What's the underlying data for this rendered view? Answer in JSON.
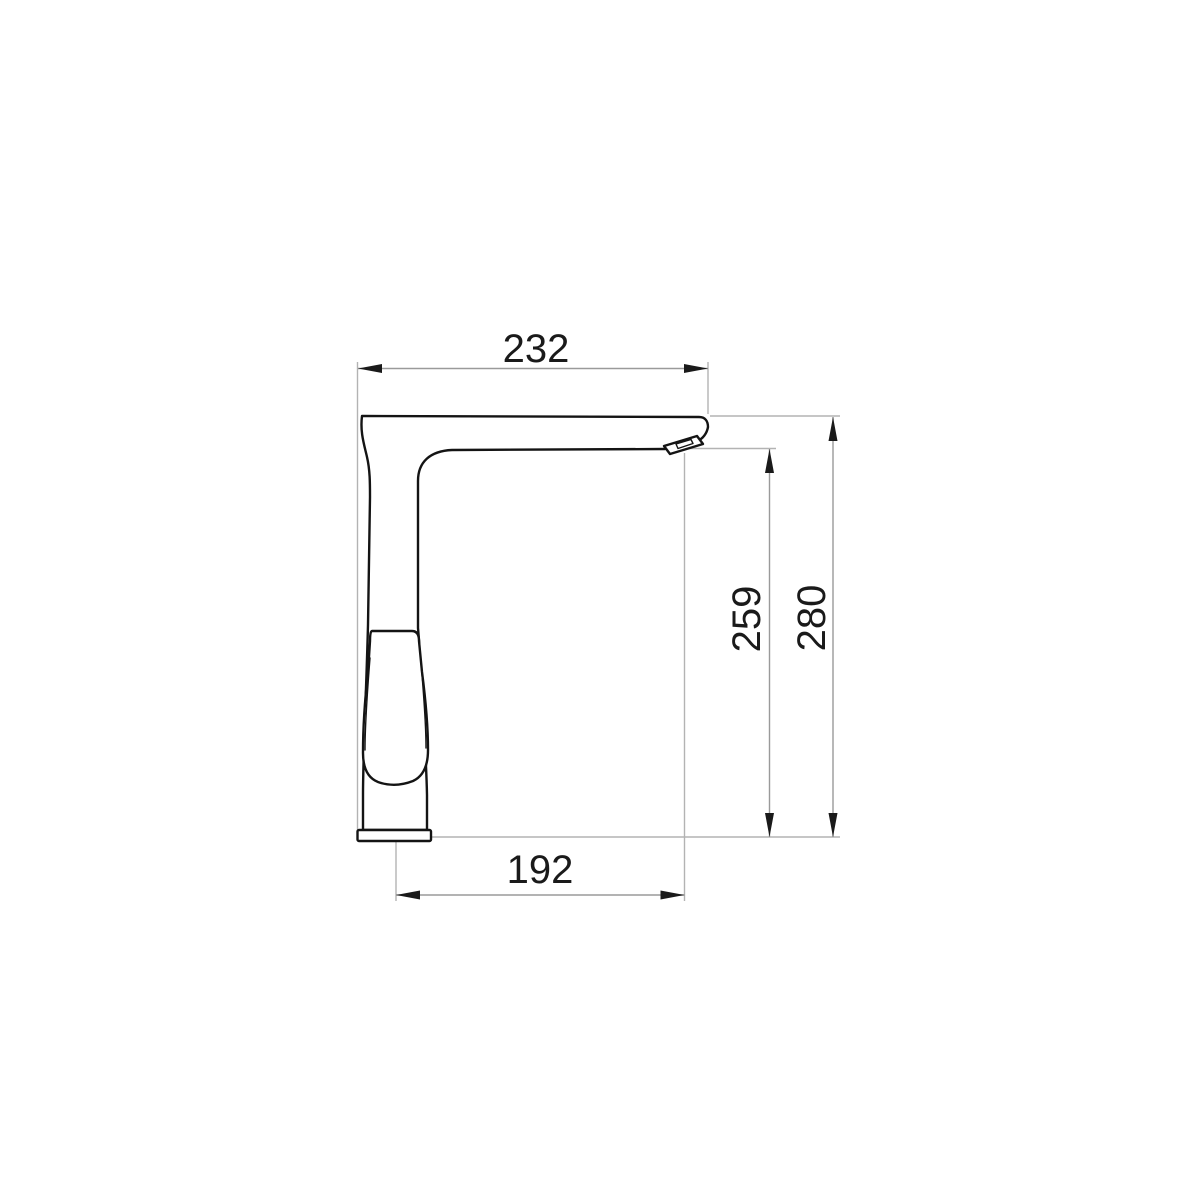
{
  "drawing": {
    "type": "technical-diagram",
    "subject": "single-lever kitchen faucet, side elevation with dimension lines",
    "dimensions": {
      "overall_width": {
        "value": "232",
        "orientation": "horizontal",
        "position": "top"
      },
      "spout_height": {
        "value": "259",
        "orientation": "vertical",
        "position": "right-inner"
      },
      "overall_height": {
        "value": "280",
        "orientation": "vertical",
        "position": "right-outer"
      },
      "spout_reach": {
        "value": "192",
        "orientation": "horizontal",
        "position": "bottom"
      }
    },
    "colors": {
      "background": "#ffffff",
      "outline": "#141414",
      "dimension_line": "#9a9a9a",
      "extension_line": "#b3b3b3",
      "arrowhead": "#1a1a1a",
      "text": "#1a1a1a"
    }
  }
}
